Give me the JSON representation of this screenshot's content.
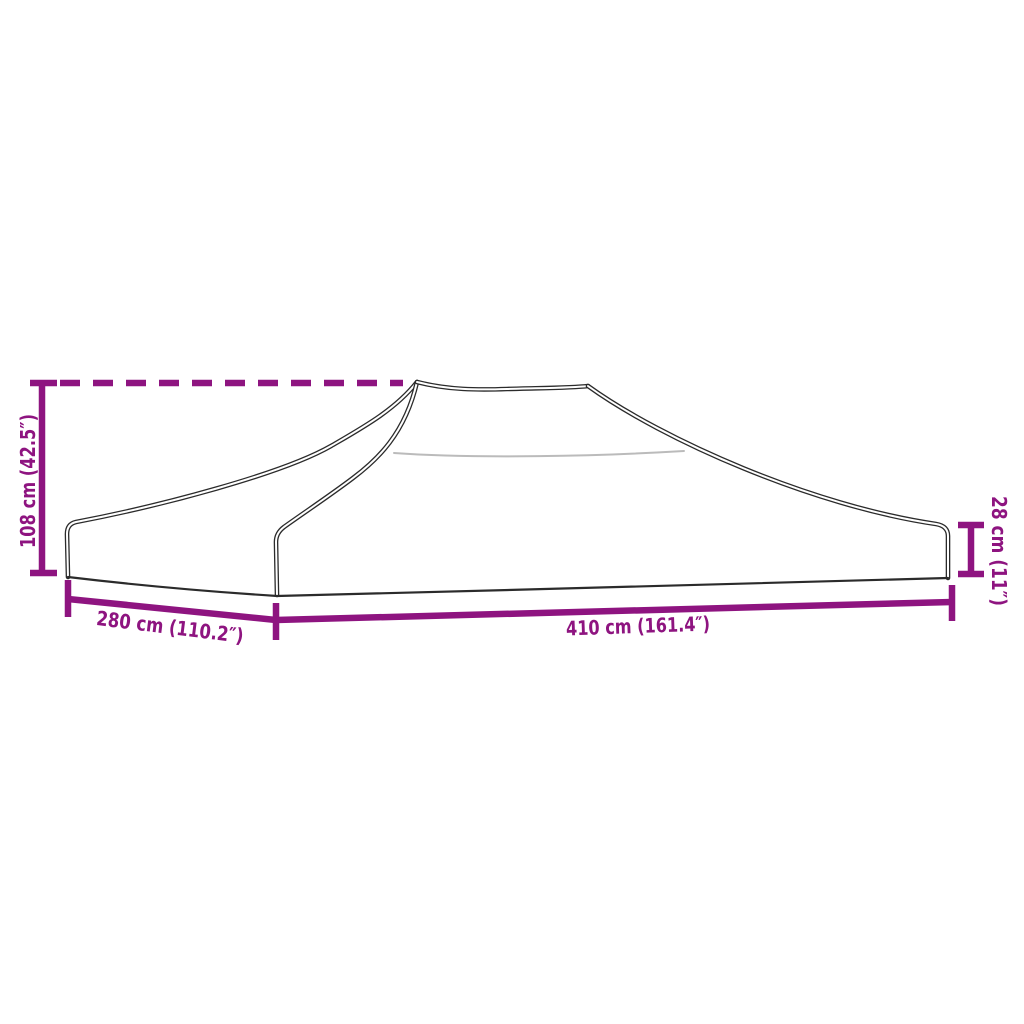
{
  "diagram": {
    "dimensions": {
      "height": {
        "label": "108 cm (42.5″)"
      },
      "side_width": {
        "label": "280 cm (110.2″)"
      },
      "front_width": {
        "label": "410 cm (161.4″)"
      },
      "valance_height": {
        "label": "28 cm (11″)"
      }
    },
    "colors": {
      "dimension_accent": "#8e1480",
      "outline": "#2b2b2b",
      "seam": "#bbbbbb",
      "background": "#ffffff"
    }
  }
}
